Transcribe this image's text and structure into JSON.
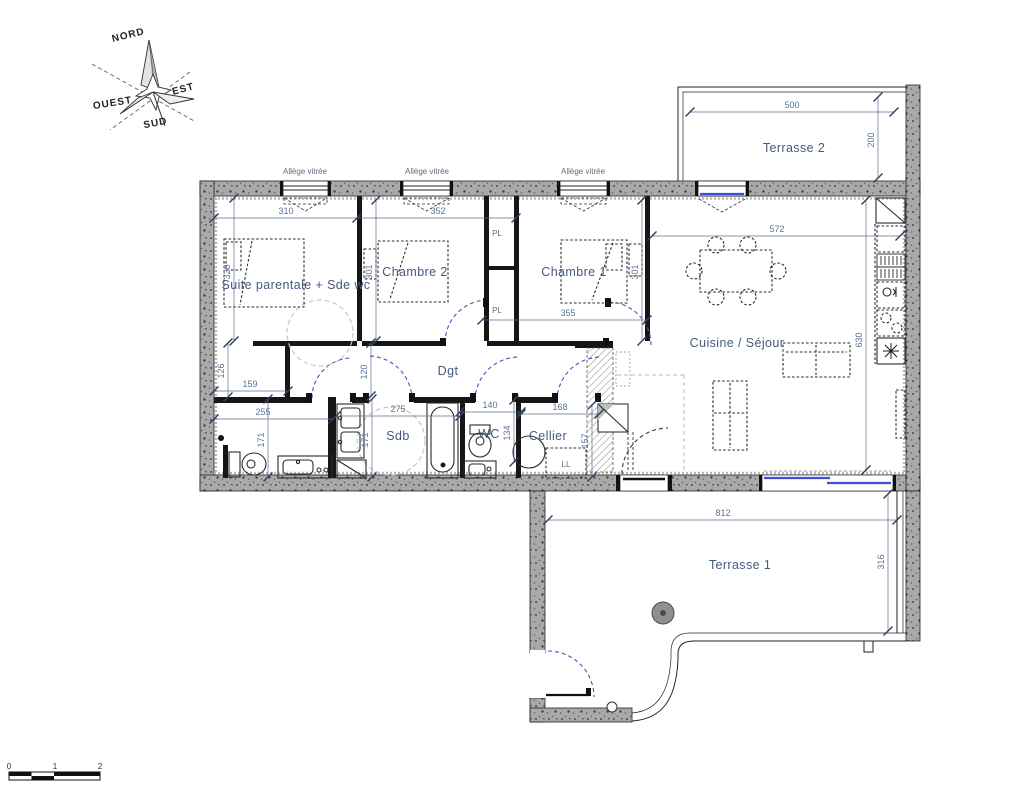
{
  "compass": {
    "north": "NORD",
    "east": "EST",
    "south": "SUD",
    "west": "OUEST"
  },
  "rooms": {
    "suite": "Suite parentale + Sde wc",
    "chambre2": "Chambre 2",
    "chambre1": "Chambre 1",
    "cuisine_sejour": "Cuisine / Séjour",
    "dgt": "Dgt",
    "sdb": "Sdb",
    "wc": "WC",
    "cellier": "Cellier",
    "terrasse1": "Terrasse 1",
    "terrasse2": "Terrasse 2"
  },
  "labels": {
    "allege": "Allège vitrée",
    "pl": "PL",
    "ll": "LL"
  },
  "dims": {
    "suite_width": "310",
    "ch2_width": "352",
    "ch1_width": "355",
    "sejour_width": "572",
    "sejour_depth": "630",
    "terrasse2_width": "500",
    "terrasse2_depth": "200",
    "terrasse1_width": "812",
    "terrasse1_depth": "316",
    "suite_depth": "320",
    "ch2_depth": "301",
    "ch1_depth": "301",
    "alcove_depth": "126",
    "alcove_width": "159",
    "ensuite_width": "255",
    "ensuite_depth": "171",
    "sdb_width": "275",
    "sdb_depth": "171",
    "dgt_width": "120",
    "wc_width": "140",
    "wc_depth": "134",
    "cellier_width": "168",
    "cellier_depth": "157"
  },
  "scale_bar": {
    "t0": "0",
    "t1": "1",
    "t2": "2"
  }
}
